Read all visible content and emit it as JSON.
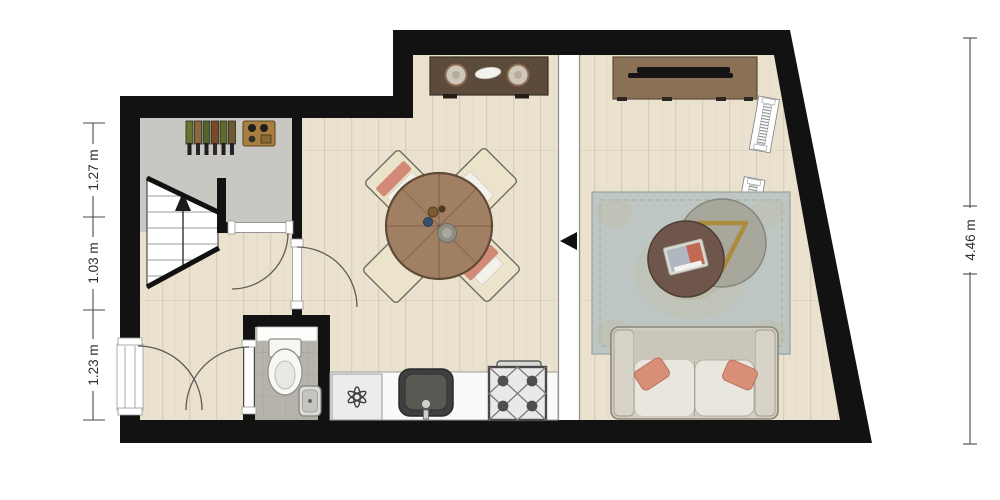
{
  "page": {
    "type": "floor-plan",
    "background": "#ffffff"
  },
  "dimensions": {
    "left": [
      "1.27 m",
      "1.03 m",
      "1.23 m"
    ],
    "right": [
      "4.46 m"
    ]
  },
  "colors": {
    "wall": "#121212",
    "wood_floor": "#eae2cf",
    "entry_floor": "#c8c7c1",
    "toilet_floor": "#b6b3ac",
    "counter": "#fafaf9",
    "rug": "#bdc6c3",
    "sofa": "#d3cec3",
    "pillow": "#d98f77",
    "dining_table": "#a17f63",
    "sideboard": "#5c4a3b",
    "tv_cabinet": "#8a7055",
    "gold_triangle": "#ab8c3f",
    "dimension_line": "#4a4a4a"
  },
  "icons": {
    "stair_direction": "up-arrow",
    "threshold_direction": "left-arrow",
    "washing_machine": "six-petal-star",
    "stove": "four-burner-cross",
    "sink": "basin-with-faucet"
  },
  "objects": [
    "staircase",
    "wine-rack",
    "entry-console",
    "toilet",
    "toilet-sink",
    "washing-machine",
    "kitchen-sink",
    "stove",
    "dining-table",
    "dining-chairs",
    "sideboard",
    "tv-cabinet",
    "tv",
    "rug",
    "side-table",
    "coffee-table",
    "sofa",
    "windows",
    "entrance-door",
    "interior-doors"
  ],
  "counts": {
    "windows_diagonal_wall": 3,
    "dining_chairs": 4,
    "wine_bottles": 6
  }
}
